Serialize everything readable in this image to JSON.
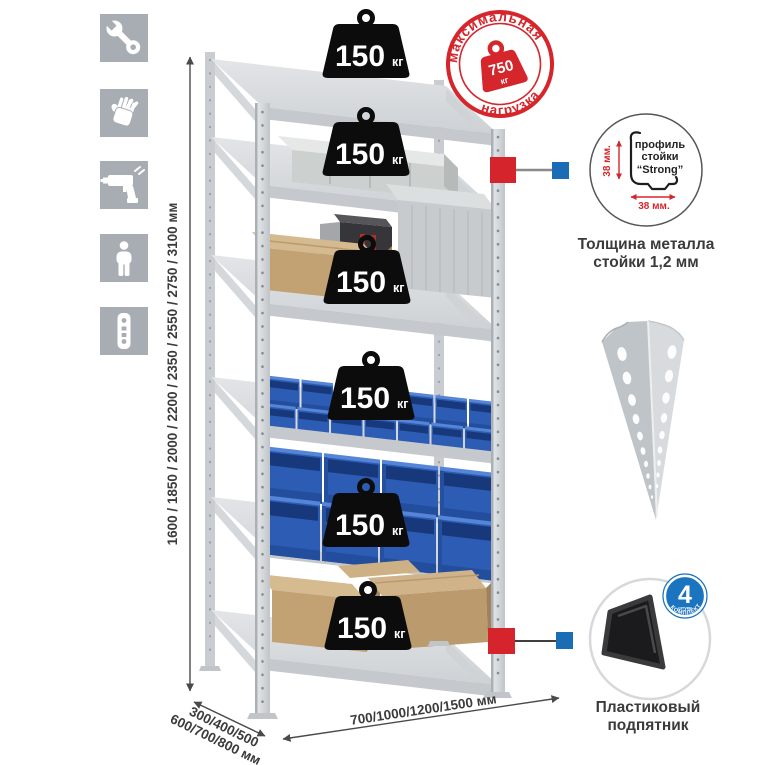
{
  "colors": {
    "accent_red": "#d5262c",
    "accent_blue": "#1a6cb5",
    "icon_gray": "#a8adb3",
    "count_badge_blue": "#1b74bf",
    "bin_blue": "#2d5cb4",
    "metal_gray": "#d3d6d9",
    "text_dark": "#3b3b3b"
  },
  "sidebar": {
    "icons": [
      {
        "name": "wrench"
      },
      {
        "name": "gloves"
      },
      {
        "name": "drill"
      },
      {
        "name": "person"
      },
      {
        "name": "perforated-post"
      }
    ]
  },
  "dimensions": {
    "height_label": "1600 / 1850 / 2000 / 2200 / 2350 / 2550 / 2750 / 3100 мм",
    "depth_label_line1": "300/400/500",
    "depth_label_line2": "600/700/800 мм",
    "width_label": "700/1000/1200/1500 мм"
  },
  "max_load_stamp": {
    "arc_top": "максимальная",
    "arc_bottom": "нагрузка",
    "value": "750",
    "unit": "кг"
  },
  "shelf_load_badge": {
    "value": "150",
    "unit": "кг"
  },
  "profile_detail": {
    "label_line1": "профиль",
    "label_line2": "стойки",
    "label_line3": "“Strong”",
    "height_dim": "38 мм.",
    "width_dim": "38 мм.",
    "caption_line1": "Толщина металла",
    "caption_line2": "стойки 1,2 мм"
  },
  "foot_detail": {
    "badge_value": "4",
    "badge_small_text": "штуки",
    "badge_arc_text": "В КОМПЛЕКТЕ",
    "caption_line1": "Пластиковый",
    "caption_line2": "подпятник"
  }
}
